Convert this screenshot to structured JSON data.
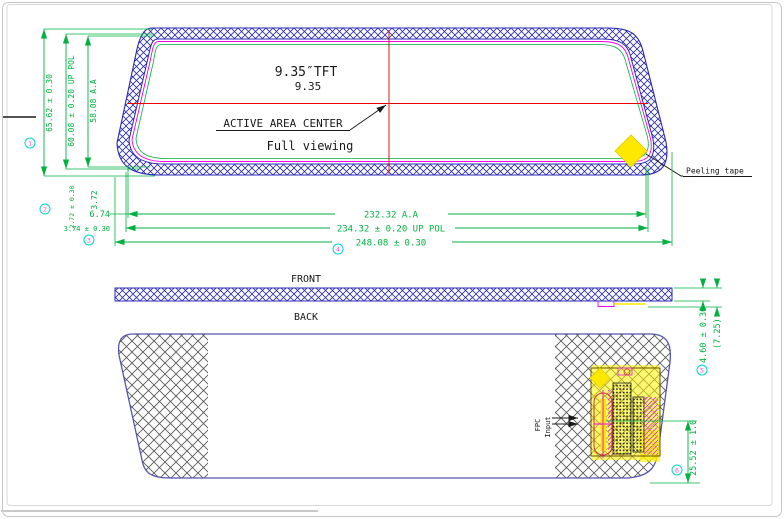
{
  "top_view": {
    "size_label": "9.35″TFT",
    "size_value": "9.35",
    "center_label": "ACTIVE AREA CENTER",
    "viewing_label": "Full viewing",
    "peeling_tape_label": "Peeling tape",
    "dims": {
      "height_outline": "65.62 ± 0.30",
      "height_pol": "60.08 ± 0.20 UP POL",
      "height_aa": "58.08 A.A",
      "gap_bottom_aa": "3.72",
      "gap_bottom_pol": "2.72 ± 0.30",
      "gap_left_aa": "6.74",
      "gap_left_pol": "3.74 ± 0.30",
      "width_aa": "232.32 A.A",
      "width_pol": "234.32 ± 0.20 UP POL",
      "width_outline": "248.08 ± 0.30"
    }
  },
  "side_view": {
    "front_label": "FRONT",
    "back_label": "BACK",
    "dims": {
      "thickness": "4.60 ± 0.30",
      "total_thickness": "(7.25)"
    }
  },
  "back_view": {
    "fpc_label_line1": "FPC",
    "fpc_label_line2": "Input",
    "dims": {
      "fpc_offset": "25.52 ± 1.0"
    }
  },
  "balloons": [
    "1",
    "2",
    "3",
    "4",
    "5",
    "6"
  ],
  "colors": {
    "dimension_green": "#00b140",
    "outline_blue": "#2a2ab4",
    "back_outline_purple": "#5555b8",
    "pol_magenta": "#ee00ee",
    "centerline_red": "#e80000",
    "tape_yellow": "#ffe800",
    "balloon_cyan": "#00d6d6",
    "balloon_magenta": "#ff44dd"
  }
}
